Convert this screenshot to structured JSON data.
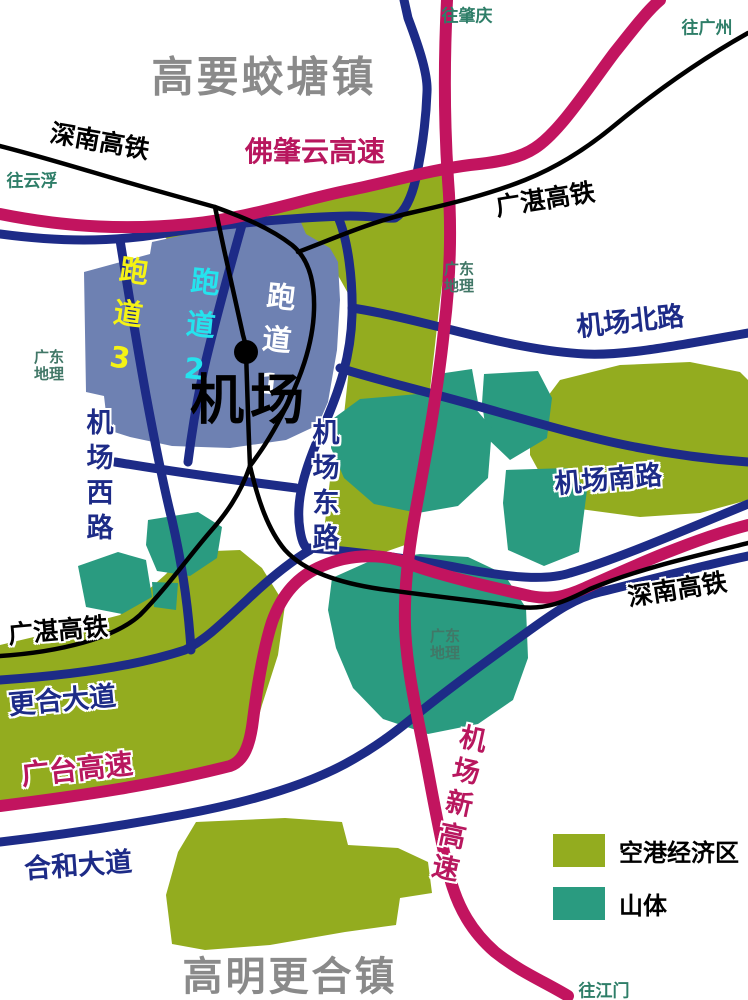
{
  "map": {
    "titles": {
      "top_town": "高要蛟塘镇",
      "bottom_town": "高明更合镇"
    },
    "railways": {
      "shennan_nw": "深南高铁",
      "shennan_se": "深南高铁",
      "guangzhan_ne": "广湛高铁",
      "guangzhan_sw": "广湛高铁"
    },
    "expressways": {
      "fozhaoyun": "佛肇云高速",
      "guangtai": "广台高速",
      "airport_new": "机场新高速"
    },
    "roads": {
      "airport_north": "机场北路",
      "airport_south": "机场南路",
      "airport_west": "机场西路",
      "airport_east": "机场东路",
      "genghe_avenue": "更合大道",
      "hehe_avenue": "合和大道"
    },
    "airport": {
      "name": "机场",
      "runway_1": "跑道1",
      "runway_2": "跑道2",
      "runway_3": "跑道3"
    },
    "directions": {
      "yunfu": "往云浮",
      "zhaoqing": "往肇庆",
      "guangzhou": "往广州",
      "jiangmen": "往江门"
    },
    "watermark": {
      "line1": "广东",
      "line2": "地理"
    },
    "legend": {
      "items": [
        {
          "label": "空港经济区",
          "color": "#93ac1f"
        },
        {
          "label": "山体",
          "color": "#2a9b80"
        }
      ]
    },
    "colors": {
      "economic_zone": "#93ac1f",
      "mountain": "#2a9b80",
      "airport_area": "#6e81b2",
      "expressway": "#c2145f",
      "road": "#1d2b87",
      "railway": "#000000",
      "town_text": "#8a8a8a",
      "direction_text": "#2e7e68",
      "runway1_text": "#ffffff",
      "runway2_text": "#25e3ee",
      "runway3_text": "#f5f315"
    }
  }
}
